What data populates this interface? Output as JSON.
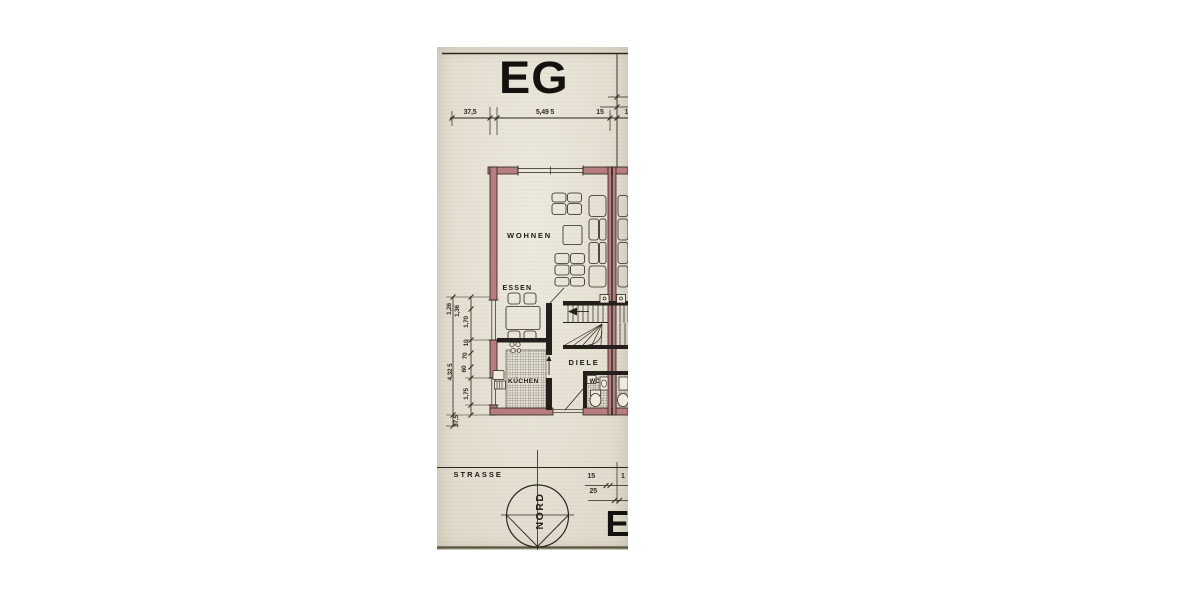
{
  "sheet": {
    "title": "EG",
    "rooms": {
      "wohnen": "WOHNEN",
      "essen": "ESSEN",
      "kueche": "KÜCHEN",
      "diele": "DIELE",
      "wc": "WC"
    },
    "dims": {
      "top": [
        "37,5",
        "5,49 5",
        "15",
        "1"
      ],
      "left": [
        "1,26",
        "1,36",
        "1,70",
        "10",
        "70",
        "60",
        "4,32 5",
        "1,75",
        "37,5"
      ],
      "bottom": [
        "15",
        "1",
        "25"
      ]
    },
    "site": {
      "street": "STRASSE",
      "north": "NORD",
      "partial_label": "EI"
    },
    "colors": {
      "paper": "#e9e4d5",
      "wall_fill": "#b67e7e",
      "ink": "#2b2520"
    }
  }
}
